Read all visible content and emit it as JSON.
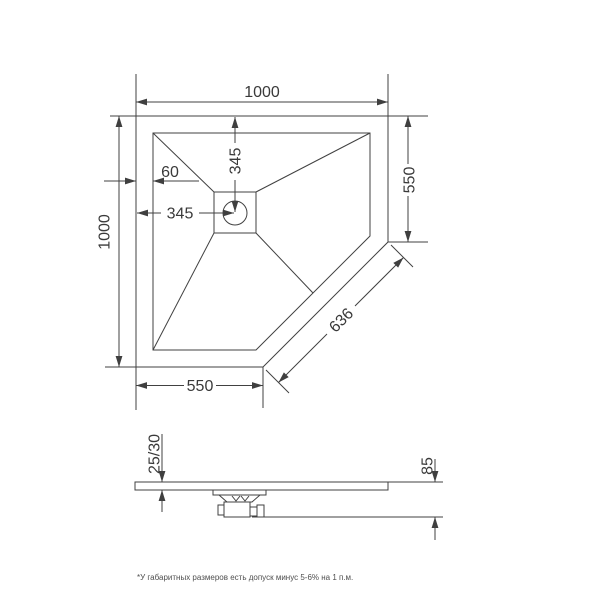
{
  "drawing": {
    "type": "technical-dimension-drawing",
    "subject": "pentagonal shower tray, top view and side view",
    "top_view": {
      "dim_width_top": "1000",
      "dim_height_left": "1000",
      "dim_right_side": "550",
      "dim_bottom_side": "550",
      "dim_diagonal_cut": "636",
      "dim_drain_from_top": "345",
      "dim_drain_from_left": "345",
      "dim_rim_width": "60"
    },
    "side_view": {
      "dim_tray_thickness": "25/30",
      "dim_total_height_with_drain": "85"
    },
    "footnote": "*У габаритных размеров есть допуск минус 5-6% на 1 п.м.",
    "theme": {
      "line_color": "#414141",
      "text_color": "#3a3a3a",
      "background": "#ffffff"
    }
  }
}
